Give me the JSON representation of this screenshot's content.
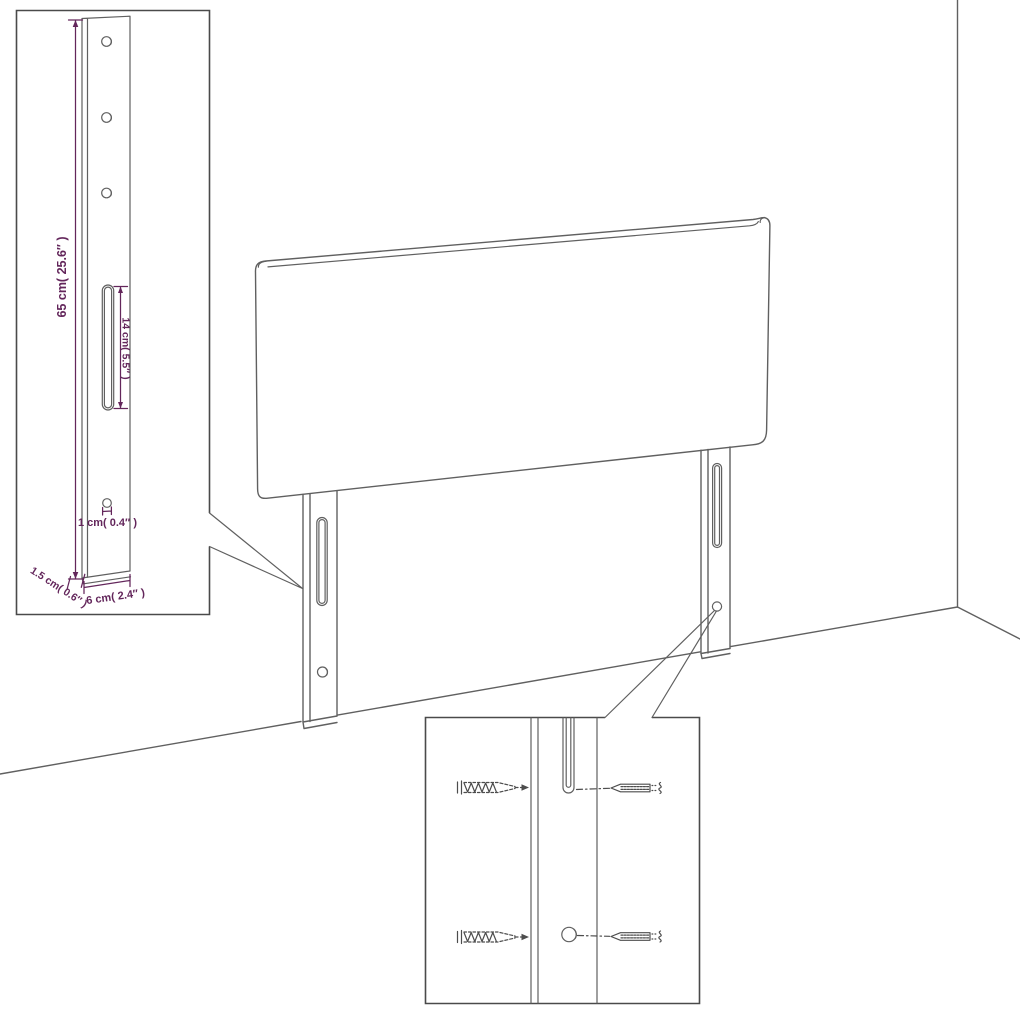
{
  "diagram": {
    "subject": "headboard-with-legs-assembly-drawing",
    "leg_detail": {
      "height_label": "65 cm( 25.6″ )",
      "slot_length_label": "14 cm( 5.5″ )",
      "hole_diameter_label": "1 cm( 0.4″ )",
      "thickness_label": "1.5 cm( 0.6″ )",
      "width_label": "6 cm( 2.4″ )"
    },
    "colors": {
      "background": "#ffffff",
      "drawing_line": "#606060",
      "inset_border": "#4a4a4a",
      "dimension_accent": "#63265b"
    }
  }
}
